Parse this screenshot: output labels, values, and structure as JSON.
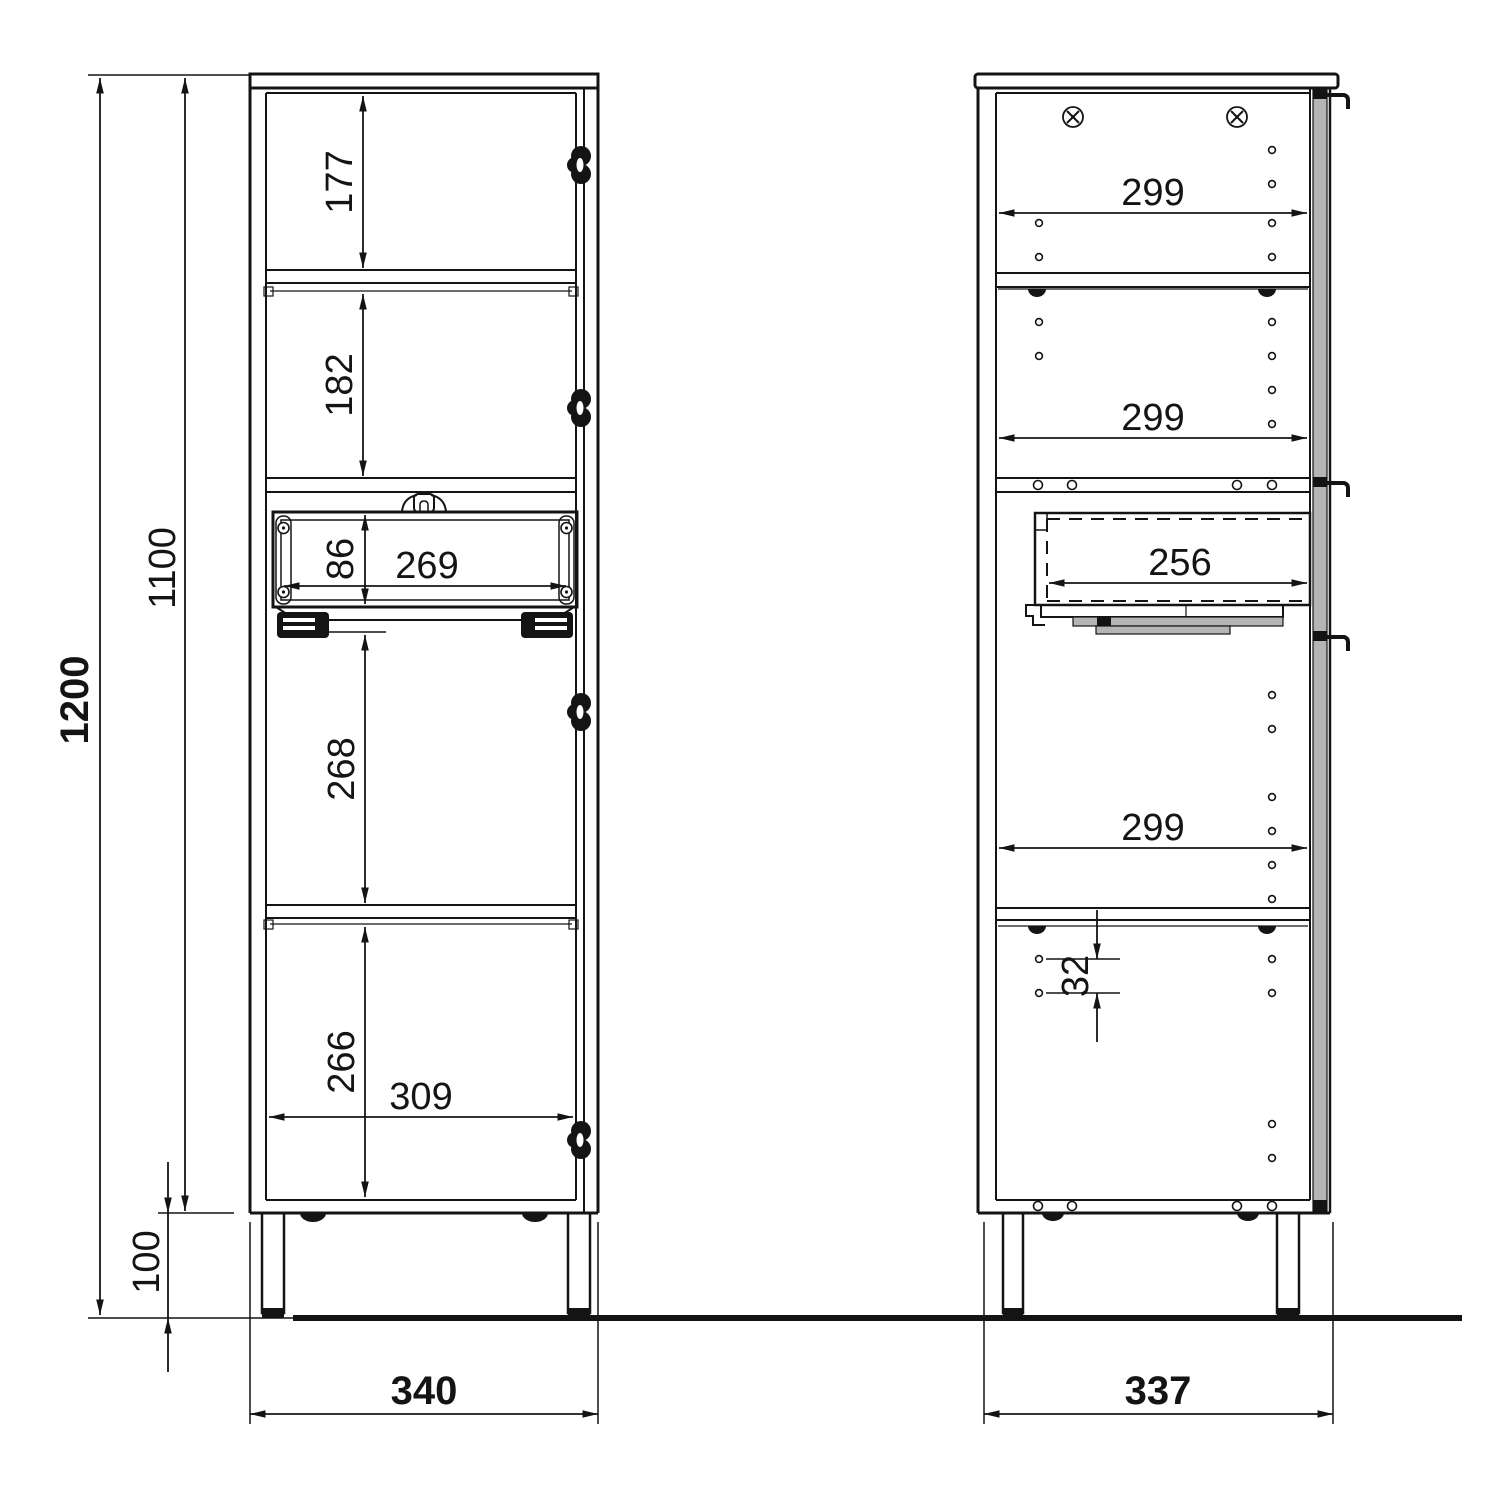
{
  "dimensions": {
    "overall": {
      "total_height": "1200",
      "body_height": "1100",
      "leg_height": "100"
    },
    "front": {
      "top_compartment_height": "177",
      "second_compartment_height": "182",
      "drawer_opening_height": "86",
      "drawer_inner_width": "269",
      "third_compartment_height": "268",
      "bottom_compartment_height": "266",
      "interior_width": "309",
      "overall_width": "340"
    },
    "side": {
      "top_depth": "299",
      "middle_depth": "299",
      "drawer_depth": "256",
      "lower_depth": "299",
      "shelf_hole_pitch": "32",
      "overall_depth": "337"
    }
  }
}
